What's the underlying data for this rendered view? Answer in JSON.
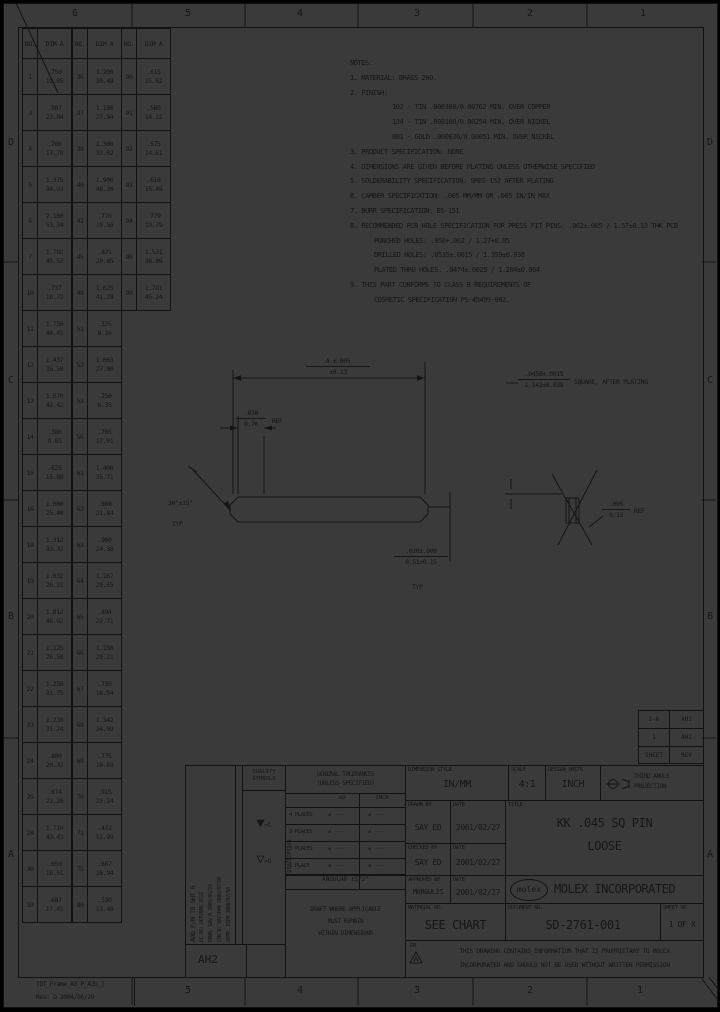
{
  "colors": {
    "background": "#3a3a3a",
    "ink": "#161616"
  },
  "zones": {
    "top": [
      "6",
      "5",
      "4",
      "3",
      "2",
      "1"
    ],
    "bottom": [
      "5",
      "4",
      "3",
      "2",
      "1"
    ],
    "left": [
      "D",
      "C",
      "B",
      "A"
    ],
    "right": [
      "D",
      "C",
      "B",
      "A"
    ]
  },
  "frame_label": {
    "line1": "[DT_Frame_A3_P_A3U_]",
    "line2": "Rev: D 2004/06/29"
  },
  "dim_table": {
    "header_no": "NO.",
    "header_dim": "DIM A",
    "groups": [
      {
        "rows": [
          [
            "1",
            ".750",
            "19.05"
          ],
          [
            "3",
            ".907",
            "23.04"
          ],
          [
            "4",
            ".700",
            "17.78"
          ],
          [
            "5",
            "1.375",
            "34.93"
          ],
          [
            "6",
            "2.100",
            "53.34"
          ],
          [
            "7",
            "1.792",
            "45.52"
          ],
          [
            "10",
            ".737",
            "18.72"
          ],
          [
            "11",
            "1.750",
            "44.45"
          ],
          [
            "12",
            "1.437",
            "36.50"
          ],
          [
            "13",
            "1.670",
            "42.42"
          ],
          [
            "14",
            ".380",
            "9.65"
          ],
          [
            "15",
            ".625",
            "15.88"
          ],
          [
            "16",
            "1.000",
            "25.40"
          ],
          [
            "18",
            "1.312",
            "33.32"
          ],
          [
            "19",
            "1.032",
            "26.21"
          ],
          [
            "20",
            "1.812",
            "46.02"
          ],
          [
            "21",
            "1.125",
            "28.58"
          ],
          [
            "22",
            "1.250",
            "31.75"
          ],
          [
            "23",
            "1.230",
            "31.24"
          ],
          [
            "24",
            ".800",
            "20.32"
          ],
          [
            "25",
            ".874",
            "22.20"
          ],
          [
            "28",
            "1.710",
            "43.43"
          ],
          [
            "30",
            ".650",
            "16.51"
          ],
          [
            "33",
            ".687",
            "17.45"
          ]
        ]
      },
      {
        "rows": [
          [
            "36",
            "1.200",
            "30.48"
          ],
          [
            "37",
            "1.100",
            "27.94"
          ],
          [
            "38",
            "1.300",
            "33.02"
          ],
          [
            "40",
            "1.900",
            "48.26"
          ],
          [
            "41",
            ".770",
            "19.56"
          ],
          [
            "45",
            ".821",
            "20.85"
          ],
          [
            "48",
            "1.625",
            "41.28"
          ],
          [
            "51",
            ".325",
            "8.26"
          ],
          [
            "52",
            "1.063",
            "27.00"
          ],
          [
            "53",
            ".250",
            "6.35"
          ],
          [
            "56",
            ".705",
            "17.91"
          ],
          [
            "61",
            "1.406",
            "35.71"
          ],
          [
            "62",
            ".860",
            "21.84"
          ],
          [
            "63",
            ".960",
            "24.38"
          ],
          [
            "64",
            "1.167",
            "29.65"
          ],
          [
            "65",
            ".894",
            "22.71"
          ],
          [
            "66",
            "1.150",
            "29.21"
          ],
          [
            "67",
            ".730",
            "18.54"
          ],
          [
            "68",
            "1.342",
            "34.09"
          ],
          [
            "69",
            ".775",
            "19.69"
          ],
          [
            "70",
            ".915",
            "23.24"
          ],
          [
            "71",
            ".472",
            "11.99"
          ],
          [
            "75",
            ".667",
            "16.94"
          ],
          [
            "80",
            ".530",
            "13.46"
          ]
        ]
      },
      {
        "rows": [
          [
            "90",
            ".615",
            "15.62"
          ],
          [
            "91",
            ".560",
            "14.22"
          ],
          [
            "92",
            ".575",
            "14.61"
          ],
          [
            "93",
            ".610",
            "15.49"
          ],
          [
            "94",
            ".779",
            "19.79"
          ],
          [
            "96",
            "1.531",
            "38.89"
          ],
          [
            "99",
            "1.781",
            "45.24"
          ]
        ]
      }
    ]
  },
  "notes": {
    "lines": [
      {
        "text": "NOTES:",
        "indent": 0
      },
      {
        "text": "1. MATERIAL: BRASS 260.",
        "indent": 0
      },
      {
        "text": "2. FINISH:",
        "indent": 0
      },
      {
        "text": "102 - TIN .000300/0.00762 MIN. OVER COPPER",
        "indent": 2
      },
      {
        "text": "134 - TIN .000100/0.00254 MIN. OVER NICKEL",
        "indent": 2
      },
      {
        "text": "801 - GOLD .000020/0.00051 MIN. OVER NICKEL",
        "indent": 2
      },
      {
        "text": "3. PRODUCT SPECIFICATION: NONE",
        "indent": 0
      },
      {
        "text": "4. DIMENSIONS ARE GIVEN BEFORE PLATING UNLESS OTHERWISE SPECIFIED",
        "indent": 0
      },
      {
        "text": "5. SOLDERABILITY SPECIFICATION: SMES-152 AFTER PLATING",
        "indent": 0
      },
      {
        "text": "6. CAMBER SPECIFICATION: .005 MM/MM OR .005 IN/IN MAX",
        "indent": 0
      },
      {
        "text": "7. BURR SPECIFICATION: BS-151",
        "indent": 0
      },
      {
        "text": "8. RECOMMENDED PCB HOLE SPECIFICATION FOR PRESS FIT PINS: .062±.005 / 1.57±0.13 THK PCB",
        "indent": 0
      },
      {
        "text": "PUNCHED HOLES: .050+.002 / 1.27+0.05",
        "indent": 1
      },
      {
        "text": "DRILLED HOLES: .0535±.0015 / 1.359±0.038",
        "indent": 1
      },
      {
        "text": "PLATED THRU HOLES: .0474±.0025 / 1.204±0.064",
        "indent": 1
      },
      {
        "text": "9. THIS PART CONFORMS TO CLASS B REQUIREMENTS OF",
        "indent": 0
      },
      {
        "text": "COSMETIC SPECIFICATION PS-45499-002.",
        "indent": 1
      }
    ]
  },
  "figure": {
    "len_dim_top": "A ±.005",
    "len_dim_bot": "±0.13",
    "chamfer_ref_top": ".030",
    "chamfer_ref_bot": "0.76",
    "chamfer_ref_suffix": "REF",
    "angle": "30°±15°",
    "angle_typ": "TYP",
    "sq_top": ".0450±.0015",
    "sq_bot": "1.143±0.038",
    "sq_suffix": "SQUARE, AFTER PLATING",
    "tip_top": ".020±.006",
    "tip_bot": "0.51±0.15",
    "tip_typ": "TYP",
    "end_ref_top": ".005",
    "end_ref_bot": "0.13",
    "end_ref_suffix": "REF"
  },
  "sheet_rev": {
    "rows": [
      [
        "2-6",
        "AH2"
      ],
      [
        "1",
        "AH2"
      ]
    ],
    "footer": [
      "SHEET",
      "REV"
    ]
  },
  "title_block": {
    "revision_strip": {
      "lines": [
        "ADD P/N TO SHT 6",
        "EC NO: UCP2008 3717",
        "DRWN: GAV_R  2008/06/23",
        "CHK'D: DAITHAN  2008/07/08",
        "APPR: ESPH  2008/07/08"
      ],
      "desc_label": "DESCRIPTION",
      "rev_box": "AH2"
    },
    "quality": {
      "title1": "QUALITY",
      "title2": "SYMBOLS",
      "items": [
        {
          "glyph": "▼",
          "label": "=C"
        },
        {
          "glyph": "▽",
          "label": "=O"
        }
      ]
    },
    "tolerances": {
      "title1": "GENERAL TOLERANCES",
      "title2": "(UNLESS SPECIFIED)",
      "col1": "mm",
      "col2": "INCH",
      "rows": [
        {
          "label": "4 PLACES",
          "mm": "± ---",
          "inch": "± ---"
        },
        {
          "label": "3 PLACES",
          "mm": "± ---",
          "inch": "± ---"
        },
        {
          "label": "2 PLACES",
          "mm": "± ---",
          "inch": "± ---"
        },
        {
          "label": "1 PLACE",
          "mm": "± ---",
          "inch": "± ---"
        }
      ],
      "angular": "ANGULAR ±1/2°",
      "draft": [
        "DRAFT WHERE APPLICABLE",
        "MUST REMAIN",
        "WITHIN DIMENSIONS"
      ]
    },
    "info": {
      "dim_style_label": "DIMENSION STYLE",
      "dim_style": "IN/MM",
      "scale_label": "SCALE",
      "scale": "4:1",
      "units_label": "DESIGN UNITS",
      "units": "INCH",
      "proj_line1": "THIRD ANGLE",
      "proj_line2": "PROJECTION",
      "drawn_label": "DRAWN BY",
      "drawn": "SAY ED",
      "date_label": "DATE",
      "drawn_date": "2001/02/27",
      "checked_label": "CHECKED BY",
      "checked": "SAY ED",
      "checked_date": "2001/02/27",
      "approved_label": "APPROVED BY",
      "approved": "MARGULIS",
      "approved_date": "2001/02/27",
      "title_label": "TITLE",
      "title1": "KK .045 SQ PIN",
      "title2": "LOOSE",
      "logo": "molex",
      "company": "MOLEX INCORPORATED",
      "material_label": "MATERIAL NO.",
      "material": "SEE CHART",
      "doc_label": "DOCUMENT NO.",
      "doc": "SD-2761-001",
      "sheet_label": "SHEET NO.",
      "sheet": "1 OF X",
      "rm": "RM",
      "rm_a": "A",
      "proprietary1": "THIS DRAWING CONTAINS INFORMATION THAT IS PROPRIETARY TO MOLEX",
      "proprietary2": "INCORPORATED AND SHOULD NOT BE USED WITHOUT WRITTEN PERMISSION"
    }
  }
}
